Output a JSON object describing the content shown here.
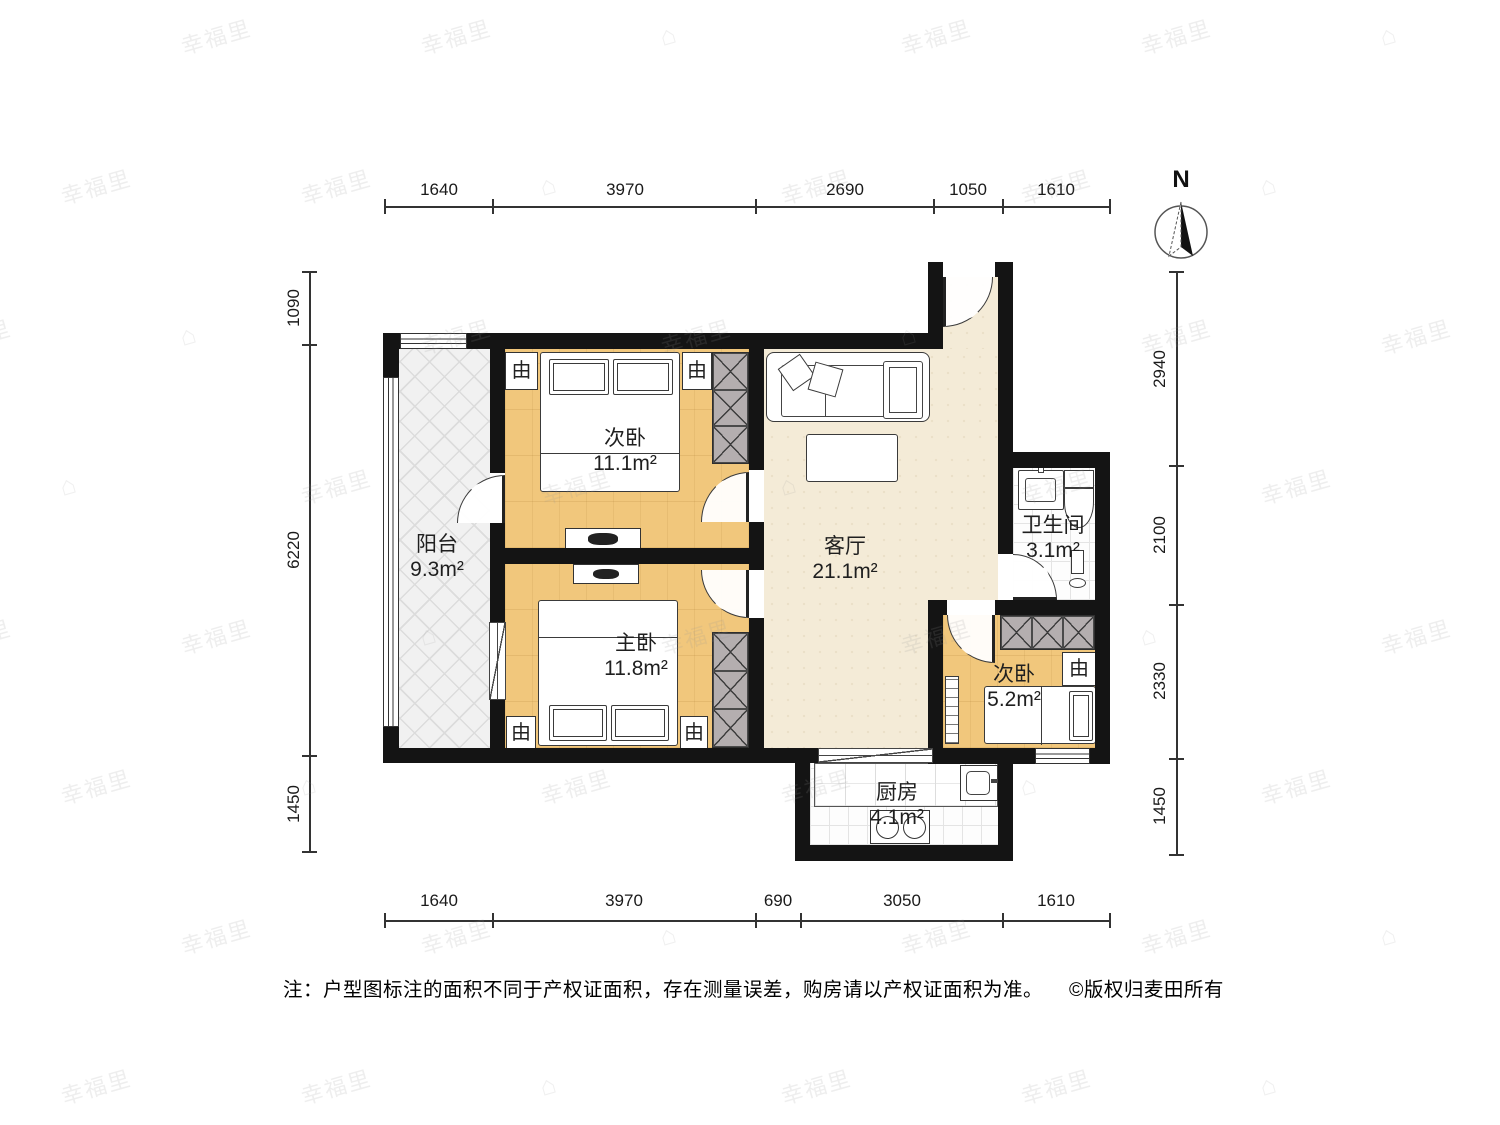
{
  "watermark": {
    "brand": "幸福里",
    "logo_glyph": "⌂"
  },
  "north": {
    "label": "N"
  },
  "icons": {
    "lamp": "由"
  },
  "rooms": {
    "balcony": {
      "name": "阳台",
      "area": "9.3m²"
    },
    "bedroom_a": {
      "name": "次卧",
      "area": "11.1m²"
    },
    "master": {
      "name": "主卧",
      "area": "11.8m²"
    },
    "living": {
      "name": "客厅",
      "area": "21.1m²"
    },
    "bathroom": {
      "name": "卫生间",
      "area": "3.1m²"
    },
    "bedroom_b": {
      "name": "次卧",
      "area": "5.2m²"
    },
    "kitchen": {
      "name": "厨房",
      "area": "4.1m²"
    }
  },
  "dimensions": {
    "top": [
      "1640",
      "3970",
      "2690",
      "1050",
      "1610"
    ],
    "bottom": [
      "1640",
      "3970",
      "690",
      "3050",
      "1610"
    ],
    "left": [
      "1090",
      "6220",
      "1450"
    ],
    "right": [
      "2940",
      "2100",
      "2330",
      "1450"
    ]
  },
  "note": {
    "text": "注：户型图标注的面积不同于产权证面积，存在测量误差，购房请以产权证面积为准。",
    "copyright": "©版权归麦田所有"
  }
}
